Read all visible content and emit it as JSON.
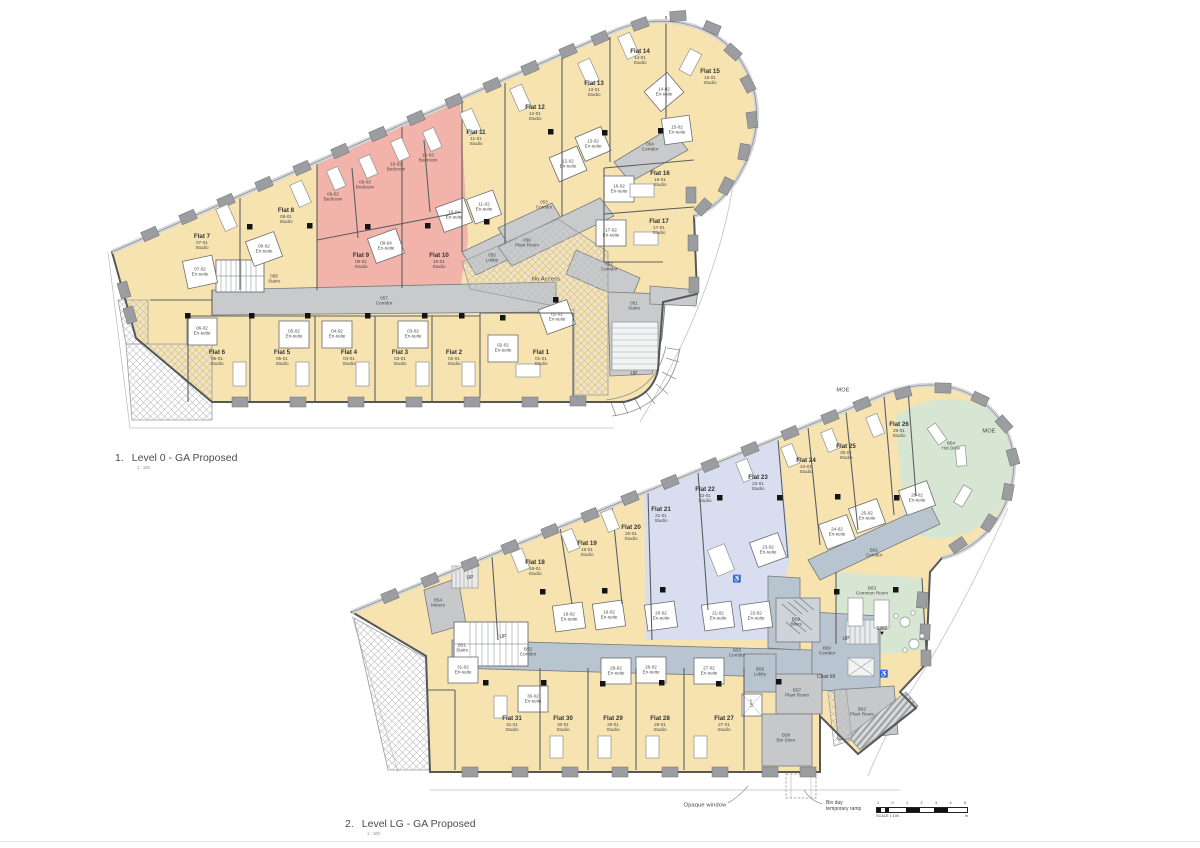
{
  "titles": {
    "t1": {
      "num": "1.",
      "text": "Level 0 - GA Proposed",
      "scale": "1 : 100"
    },
    "t2": {
      "num": "2.",
      "text": "Level LG - GA Proposed",
      "scale": "1 : 100"
    }
  },
  "colors": {
    "studio_yellow": "#f6e3b0",
    "bedroom_pink": "#f1b3aa",
    "accessible_blue": "#d8deef",
    "amenity_green": "#d7e6d2",
    "circulation_gray": "#c8cacb",
    "circulation_bluegray": "#b8c4cf",
    "wall": "#5d5f62",
    "column_black": "#141414"
  },
  "plans": {
    "level0": {
      "rooms": [
        {
          "flat": "Flat 7",
          "unit": "07-01",
          "type": "Studio",
          "x": 202,
          "y": 242
        },
        {
          "flat": "Flat 8",
          "unit": "08-01",
          "type": "Studio",
          "x": 286,
          "y": 216
        },
        {
          "flat": "Flat 9",
          "unit": "09-01",
          "type": "Studio",
          "x": 361,
          "y": 261
        },
        {
          "flat": "Flat 10",
          "unit": "10-01",
          "type": "Studio",
          "x": 439,
          "y": 261
        },
        {
          "flat": "Flat 11",
          "unit": "11-01",
          "type": "Studio",
          "x": 476,
          "y": 138
        },
        {
          "flat": "Flat 12",
          "unit": "12-01",
          "type": "Studio",
          "x": 535,
          "y": 113
        },
        {
          "flat": "Flat 13",
          "unit": "13-01",
          "type": "Studio",
          "x": 594,
          "y": 89
        },
        {
          "flat": "Flat 14",
          "unit": "14-01",
          "type": "Studio",
          "x": 640,
          "y": 57
        },
        {
          "flat": "Flat 15",
          "unit": "15-01",
          "type": "Studio",
          "x": 710,
          "y": 77
        },
        {
          "flat": "Flat 16",
          "unit": "16-01",
          "type": "Studio",
          "x": 660,
          "y": 179
        },
        {
          "flat": "Flat 17",
          "unit": "17-01",
          "type": "Studio",
          "x": 659,
          "y": 227
        },
        {
          "flat": "Flat 6",
          "unit": "06-01",
          "type": "Studio",
          "x": 217,
          "y": 358
        },
        {
          "flat": "Flat 5",
          "unit": "05-01",
          "type": "Studio",
          "x": 282,
          "y": 358
        },
        {
          "flat": "Flat 4",
          "unit": "04-01",
          "type": "Studio",
          "x": 349,
          "y": 358
        },
        {
          "flat": "Flat 3",
          "unit": "03-01",
          "type": "Studio",
          "x": 400,
          "y": 358
        },
        {
          "flat": "Flat 2",
          "unit": "02-01",
          "type": "Studio",
          "x": 454,
          "y": 358
        },
        {
          "flat": "Flat 1",
          "unit": "01-01",
          "type": "Studio",
          "x": 541,
          "y": 358
        },
        {
          "lines": [
            "09-02",
            "Bedroom"
          ],
          "x": 333,
          "y": 197
        },
        {
          "lines": [
            "09-03",
            "Bedroom"
          ],
          "x": 365,
          "y": 185
        },
        {
          "lines": [
            "10-02",
            "Bedroom"
          ],
          "x": 396,
          "y": 167
        },
        {
          "lines": [
            "10-03",
            "Bedroom"
          ],
          "x": 428,
          "y": 158
        },
        {
          "lines": [
            "07-02",
            "En-suite"
          ],
          "x": 200,
          "y": 272
        },
        {
          "lines": [
            "08-02",
            "En-suite"
          ],
          "x": 264,
          "y": 249
        },
        {
          "lines": [
            "09-04",
            "En-suite"
          ],
          "x": 386,
          "y": 246
        },
        {
          "lines": [
            "10-04",
            "En-suite"
          ],
          "x": 454,
          "y": 215
        },
        {
          "lines": [
            "11-02",
            "En-suite"
          ],
          "x": 484,
          "y": 207
        },
        {
          "lines": [
            "12-02",
            "En-suite"
          ],
          "x": 568,
          "y": 164
        },
        {
          "lines": [
            "13-02",
            "En-suite"
          ],
          "x": 593,
          "y": 144
        },
        {
          "lines": [
            "14-02",
            "En-suite"
          ],
          "x": 664,
          "y": 92
        },
        {
          "lines": [
            "15-02",
            "En-suite"
          ],
          "x": 677,
          "y": 130
        },
        {
          "lines": [
            "16-02",
            "En-suite"
          ],
          "x": 619,
          "y": 189
        },
        {
          "lines": [
            "17-02",
            "En-suite"
          ],
          "x": 611,
          "y": 233
        },
        {
          "lines": [
            "06-02",
            "En-suite"
          ],
          "x": 202,
          "y": 331
        },
        {
          "lines": [
            "05-02",
            "En-suite"
          ],
          "x": 294,
          "y": 334
        },
        {
          "lines": [
            "04-02",
            "En-suite"
          ],
          "x": 337,
          "y": 334
        },
        {
          "lines": [
            "03-02",
            "En-suite"
          ],
          "x": 413,
          "y": 334
        },
        {
          "lines": [
            "02-02",
            "En-suite"
          ],
          "x": 503,
          "y": 348
        },
        {
          "lines": [
            "01-02",
            "En-suite"
          ],
          "x": 557,
          "y": 317
        },
        {
          "core": true,
          "lines": [
            "058",
            "Stairs"
          ],
          "x": 274,
          "y": 279
        },
        {
          "core": true,
          "lines": [
            "057",
            "Corridor"
          ],
          "x": 384,
          "y": 301
        },
        {
          "core": true,
          "lines": [
            "053",
            "Corridor"
          ],
          "x": 544,
          "y": 205
        },
        {
          "core": true,
          "lines": [
            "054",
            "Corridor"
          ],
          "x": 650,
          "y": 147
        },
        {
          "core": true,
          "lines": [
            "052",
            "Corridor"
          ],
          "x": 609,
          "y": 267
        },
        {
          "core": true,
          "lines": [
            "051",
            "Stairs"
          ],
          "x": 634,
          "y": 306
        },
        {
          "core": true,
          "lines": [
            "055",
            "Lobby"
          ],
          "x": 492,
          "y": 258
        },
        {
          "core": true,
          "lines": [
            "056",
            "Plant Room"
          ],
          "x": 527,
          "y": 243
        }
      ],
      "annotations": [
        {
          "text": "No Access",
          "x": 546,
          "y": 280,
          "cls": "big"
        },
        {
          "text": "UP",
          "x": 634,
          "y": 374
        }
      ]
    },
    "levellg": {
      "rooms": [
        {
          "flat": "Flat 18",
          "unit": "18-01",
          "type": "Studio",
          "x": 535,
          "y": 568
        },
        {
          "flat": "Flat 19",
          "unit": "19-01",
          "type": "Studio",
          "x": 587,
          "y": 549
        },
        {
          "flat": "Flat 20",
          "unit": "20-01",
          "type": "Studio",
          "x": 631,
          "y": 533
        },
        {
          "flat": "Flat 21",
          "unit": "21-01",
          "type": "Studio",
          "x": 661,
          "y": 515
        },
        {
          "flat": "Flat 22",
          "unit": "22-01",
          "type": "Studio",
          "x": 705,
          "y": 495
        },
        {
          "flat": "Flat 23",
          "unit": "23-01",
          "type": "Studio",
          "x": 758,
          "y": 483
        },
        {
          "flat": "Flat 24",
          "unit": "24-01",
          "type": "Studio",
          "x": 806,
          "y": 466
        },
        {
          "flat": "Flat 25",
          "unit": "25-01",
          "type": "Studio",
          "x": 846,
          "y": 452
        },
        {
          "flat": "Flat 26",
          "unit": "26-01",
          "type": "Studio",
          "x": 899,
          "y": 430
        },
        {
          "flat": "Flat 27",
          "unit": "27-01",
          "type": "Studio",
          "x": 724,
          "y": 724
        },
        {
          "flat": "Flat 28",
          "unit": "28-01",
          "type": "Studio",
          "x": 660,
          "y": 724
        },
        {
          "flat": "Flat 29",
          "unit": "29-01",
          "type": "Studio",
          "x": 613,
          "y": 724
        },
        {
          "flat": "Flat 30",
          "unit": "30-01",
          "type": "Studio",
          "x": 563,
          "y": 724
        },
        {
          "flat": "Flat 31",
          "unit": "31-01",
          "type": "Studio",
          "x": 512,
          "y": 724
        },
        {
          "lines": [
            "18-02",
            "En-suite"
          ],
          "x": 569,
          "y": 617
        },
        {
          "lines": [
            "19-02",
            "En-suite"
          ],
          "x": 609,
          "y": 615
        },
        {
          "lines": [
            "20-02",
            "En-suite"
          ],
          "x": 661,
          "y": 616
        },
        {
          "lines": [
            "21-02",
            "En-suite"
          ],
          "x": 718,
          "y": 616
        },
        {
          "lines": [
            "22-02",
            "En-suite"
          ],
          "x": 756,
          "y": 616
        },
        {
          "lines": [
            "23-02",
            "En-suite"
          ],
          "x": 768,
          "y": 550
        },
        {
          "lines": [
            "24-02",
            "En-suite"
          ],
          "x": 837,
          "y": 532
        },
        {
          "lines": [
            "25-02",
            "En-suite"
          ],
          "x": 867,
          "y": 516
        },
        {
          "lines": [
            "26-02",
            "En-suite"
          ],
          "x": 917,
          "y": 498
        },
        {
          "lines": [
            "27-02",
            "En-suite"
          ],
          "x": 709,
          "y": 671
        },
        {
          "lines": [
            "28-02",
            "En-suite"
          ],
          "x": 651,
          "y": 670
        },
        {
          "lines": [
            "29-02",
            "En-suite"
          ],
          "x": 616,
          "y": 671
        },
        {
          "lines": [
            "30-02",
            "En-suite"
          ],
          "x": 533,
          "y": 699
        },
        {
          "lines": [
            "31-02",
            "En-suite"
          ],
          "x": 463,
          "y": 670
        },
        {
          "core": true,
          "lines": [
            "B51",
            "Stairs"
          ],
          "x": 462,
          "y": 648
        },
        {
          "core": true,
          "lines": [
            "B52",
            "Corridor"
          ],
          "x": 528,
          "y": 652
        },
        {
          "core": true,
          "lines": [
            "B54",
            "Meters"
          ],
          "x": 438,
          "y": 603
        },
        {
          "core": true,
          "lines": [
            "B55",
            "Corridor"
          ],
          "x": 737,
          "y": 653
        },
        {
          "core": true,
          "lines": [
            "B56",
            "Lobby"
          ],
          "x": 760,
          "y": 672
        },
        {
          "core": true,
          "lines": [
            "B57",
            "Plant Room"
          ],
          "x": 797,
          "y": 693
        },
        {
          "core": true,
          "lines": [
            "B58",
            "Bin Store"
          ],
          "x": 786,
          "y": 738
        },
        {
          "core": true,
          "lines": [
            "B59",
            "Bikes"
          ],
          "x": 796,
          "y": 622
        },
        {
          "core": true,
          "lines": [
            "B60",
            "Corridor"
          ],
          "x": 827,
          "y": 651
        },
        {
          "core": true,
          "lines": [
            "B61",
            "Corridor"
          ],
          "x": 874,
          "y": 553
        },
        {
          "core": true,
          "lines": [
            "B62",
            "Plant Room"
          ],
          "x": 862,
          "y": 712
        },
        {
          "core": true,
          "lines": [
            "B63",
            "Common Room"
          ],
          "x": 872,
          "y": 591
        },
        {
          "core": true,
          "lines": [
            "B64",
            "Hot Desk"
          ],
          "x": 951,
          "y": 446
        }
      ],
      "annotations": [
        {
          "text": "MOE",
          "x": 843,
          "y": 391,
          "cls": "big"
        },
        {
          "text": "MOE",
          "x": 989,
          "y": 432,
          "cls": "big"
        },
        {
          "text": "UP",
          "x": 470,
          "y": 578
        },
        {
          "text": "UP",
          "x": 503,
          "y": 637
        },
        {
          "text": "UP",
          "x": 846,
          "y": 639
        },
        {
          "text": "Chair lift",
          "x": 826,
          "y": 677
        },
        {
          "text": "LIFT",
          "x": 752,
          "y": 703,
          "cls": "vert"
        },
        {
          "text": "1382",
          "x": 882,
          "y": 631,
          "cls": "marker",
          "marker": "▼"
        },
        {
          "text": "Opaque window",
          "x": 705,
          "y": 806,
          "cls": "big"
        },
        {
          "lines": [
            "Bin day",
            "temporary ramp"
          ],
          "x": 826,
          "y": 806,
          "cls": "left"
        }
      ]
    }
  },
  "icons": [
    {
      "name": "wheelchair-icon",
      "glyph": "♿",
      "x": 737,
      "y": 579
    },
    {
      "name": "wheelchair-icon",
      "glyph": "♿",
      "x": 884,
      "y": 674
    }
  ],
  "scalebar": {
    "ticks": [
      "1",
      "0",
      "1",
      "2",
      "3",
      "4",
      "5"
    ],
    "label": "SCALE 1:100",
    "unit": "m"
  }
}
